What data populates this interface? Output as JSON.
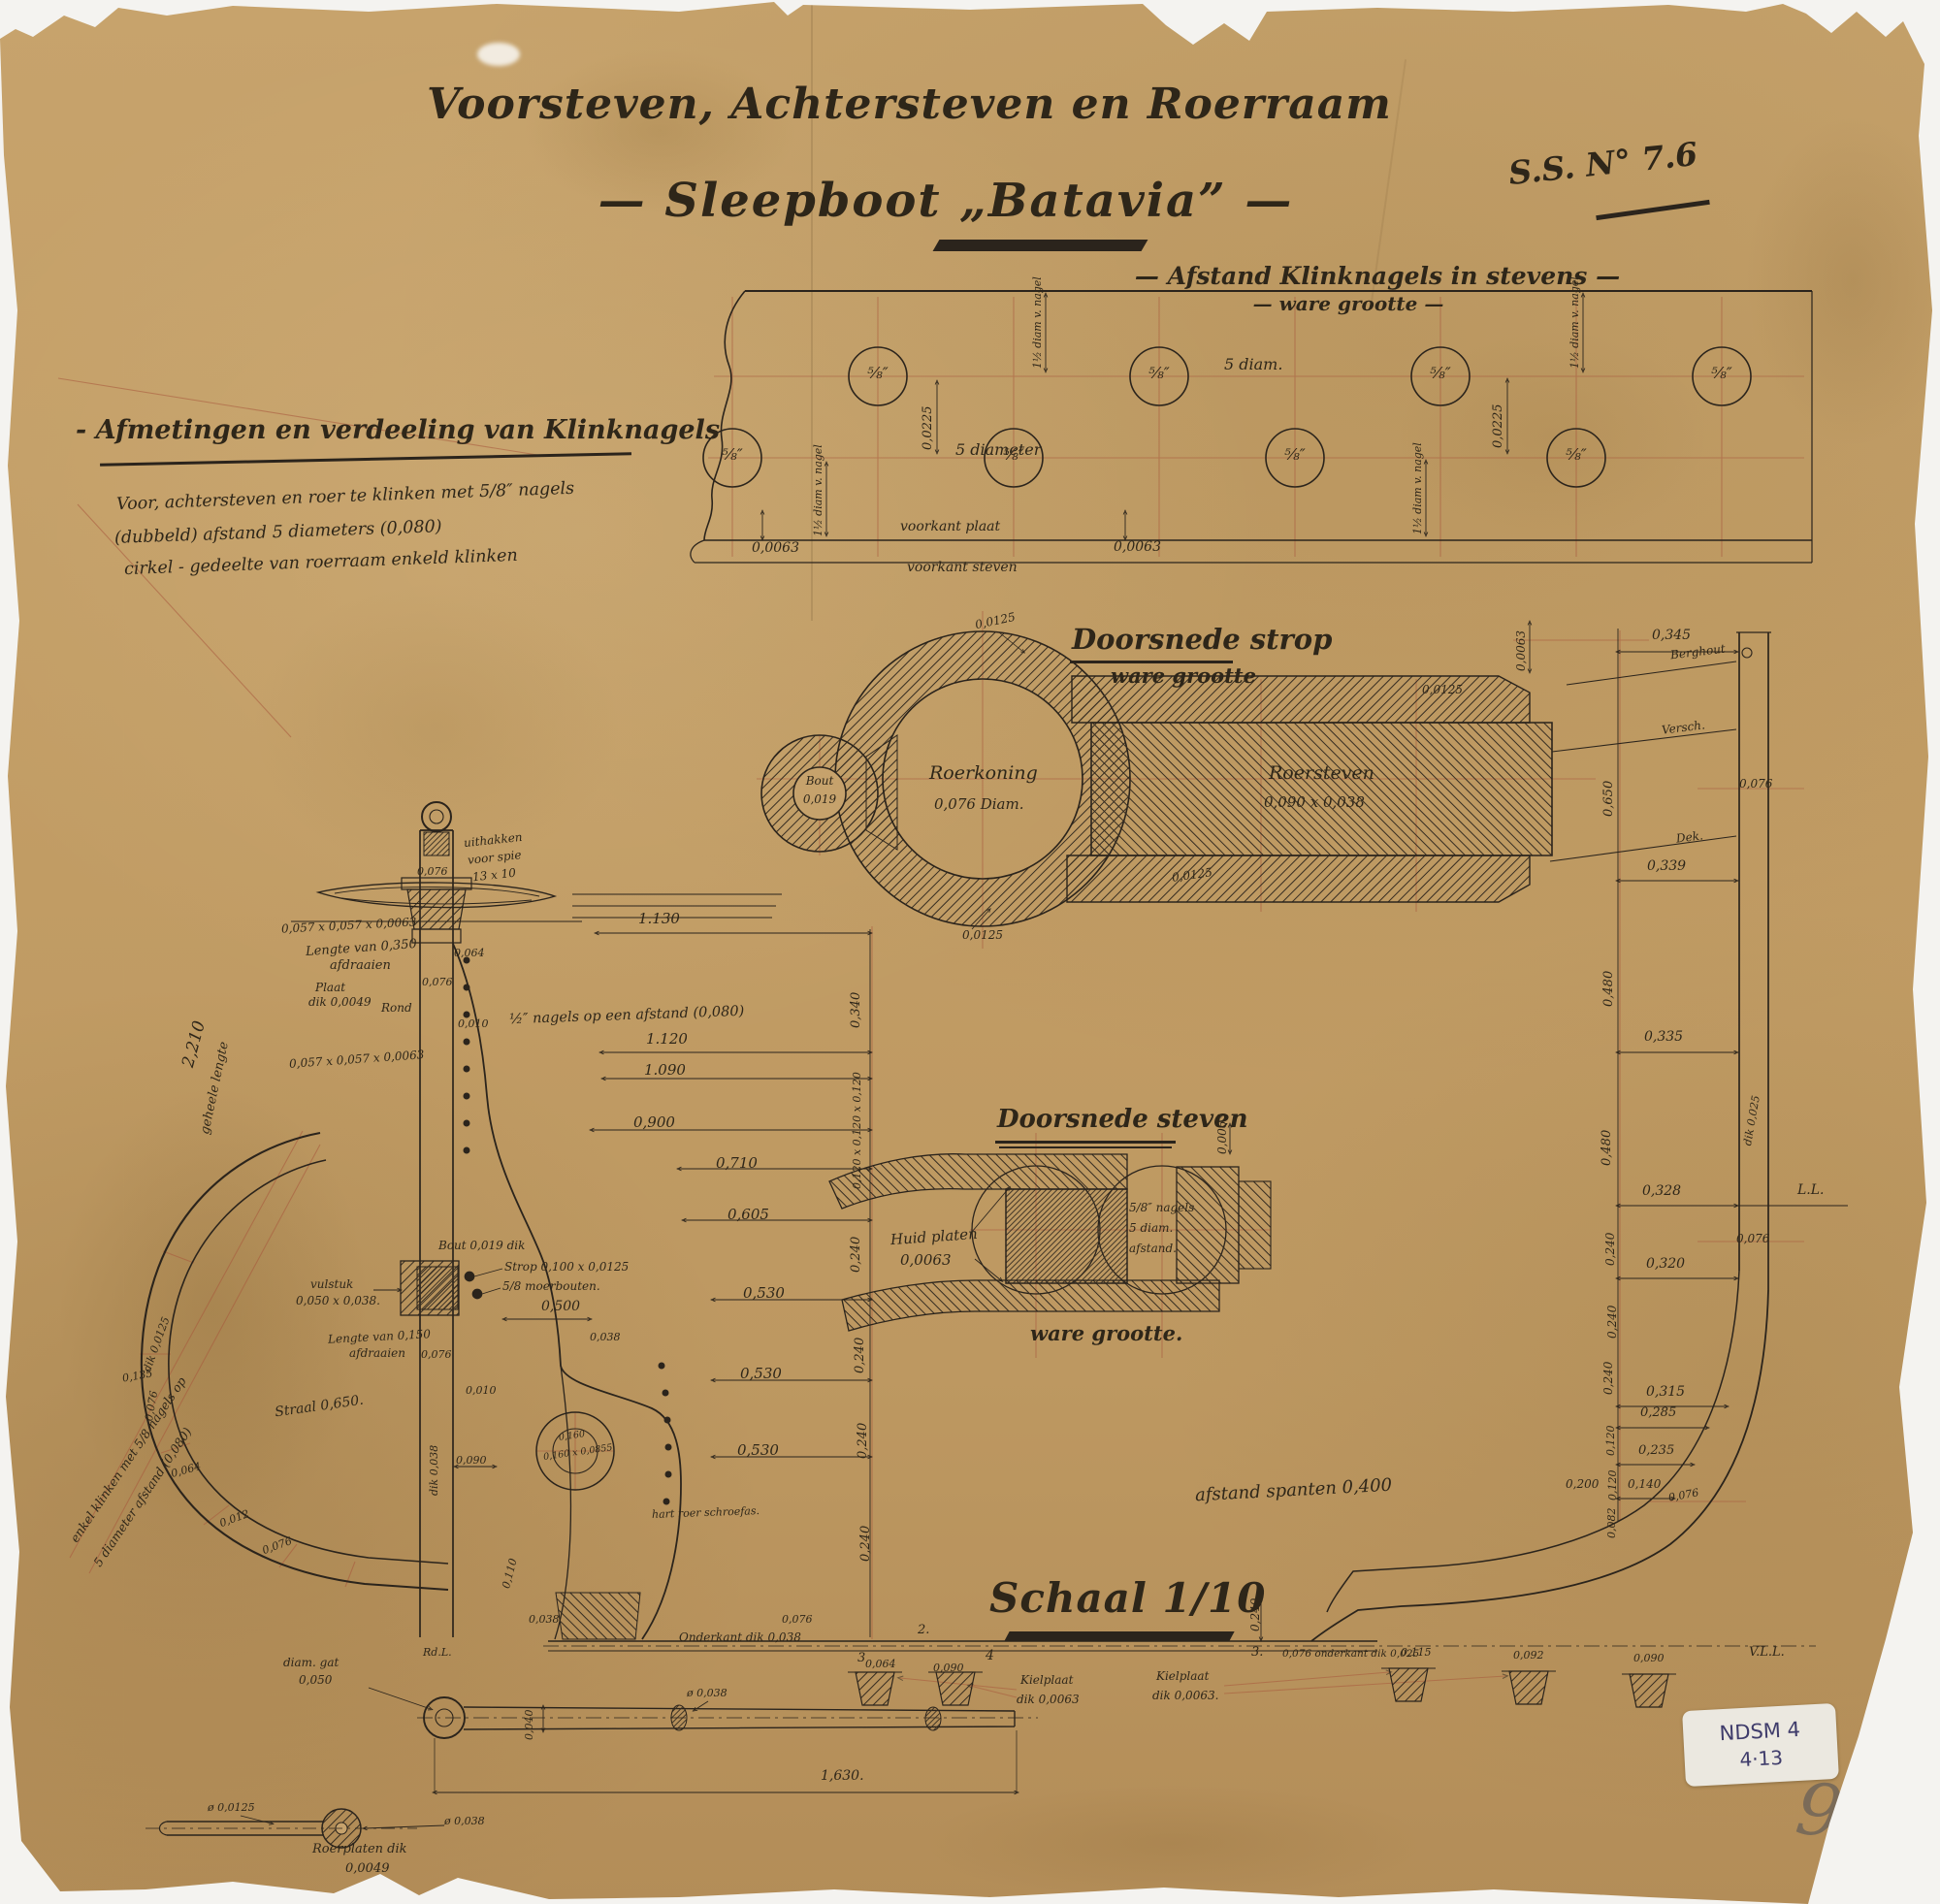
{
  "colors": {
    "paper": "#c29d65",
    "ink": "#2b241c",
    "red_construction": "#a8573c",
    "sticker_bg": "#ebe8e0",
    "sticker_ink": "#3f3c6b",
    "pencil": "#6d6358"
  },
  "header": {
    "title1": "Voorsteven, Achtersteven en Roerraam",
    "title2": "— Sleepboot „Batavia” —",
    "ssno": "S.S. N° 7.6"
  },
  "notes": {
    "heading": "- Afmetingen en verdeeling van Klinknagels",
    "l1": "Voor, achtersteven en roer te klinken met 5/8″ nagels",
    "l2": "(dubbeld)  afstand  5  diameters  (0,080)",
    "l3": "cirkel - gedeelte van roerraam  enkeld  klinken"
  },
  "plate": {
    "heading": "— Afstand Klinknagels in stevens —",
    "sub": "— ware grootte —",
    "rivet": "⅝″",
    "five_diam": "5 diam.",
    "five_diameter": "5  diameter",
    "diam_nagel": "1½ diam v. nagel",
    "d225": "0,0225",
    "d63": "0,0063",
    "voorkant_plaat": "voorkant plaat",
    "voorkant_steven": "voorkant steven"
  },
  "strop": {
    "title": "Doorsnede strop",
    "sub": "ware grootte",
    "bout1": "Bout",
    "bout2": "0,019",
    "rk1": "Roerkoning",
    "rk2": "0,076 Diam.",
    "rs1": "Roersteven",
    "rs2": "0,090 x 0,038",
    "t125": "0,0125",
    "d63": "0,0063"
  },
  "steven": {
    "title": "Doorsnede steven",
    "sub": "ware grootte.",
    "huid1": "Huid platen",
    "huid2": "0,0063",
    "n1": "5/8″ nagels",
    "n2": "5 diam.",
    "n3": "afstand.",
    "d63": "0,0063"
  },
  "lv": {
    "spie1": "uithakken",
    "spie2": "voor spie",
    "spie3": "13 x 10",
    "d076a": "0,076",
    "angle1": "0,057 x 0,057 x 0,0063",
    "l350a": "Lengte van 0,350",
    "l350b": "afdraaien",
    "plaat1": "Plaat",
    "plaat2": "dik 0,0049",
    "rond": "Rond",
    "d064": "0,064",
    "d076b": "0,076",
    "d010a": "0,010",
    "nagels": "½″ nagels op een afstand (0,080)",
    "angle2": "0,057 x 0,057 x 0,0063",
    "geheele": "geheele lengte",
    "g2210": "2,210",
    "klink1": "enkel klinken met 5/8 nagels op",
    "klink2": "5 diameter afstand (0,080)",
    "boutdik": "Bout 0,019 dik",
    "stropdim": "Strop 0,100 x 0,0125",
    "moer": "5/8 moerbouten.",
    "vul1": "vulstuk",
    "vul2": "0,050 x 0,038.",
    "l150a": "Lengte van 0,150",
    "l150b": "afdraaien",
    "d076c": "0,076",
    "d500": "0,500",
    "d038a": "0,038",
    "d010b": "0,010",
    "straal": "Straal 0,650.",
    "dik038": "dik 0,038",
    "d090": "0,090",
    "boss1": "0,160",
    "boss2": "0,160 x 0,0855",
    "dik125": "dik 0,0125",
    "r135": "0,135",
    "r076a": "0,076",
    "r064": "0,064",
    "r012": "0,012",
    "r076b": "0,076",
    "d110": "0,110",
    "d038b": "0,038",
    "rdl": "Rd.L.",
    "hart": "hart roer  schroefas."
  },
  "dims": {
    "a": "1.130",
    "b": "1.120",
    "c": "1.090",
    "d": "0,900",
    "e": "0,710",
    "f": "0,605",
    "g": "0,530",
    "r340": "0,340",
    "r120": "0,120 x 0,120 x 0,120",
    "r240": "0,240"
  },
  "profile": {
    "d345": "0,345",
    "berghout": "Berghout",
    "versch": "Versch.",
    "d650": "0,650",
    "d076a": "0,076",
    "dek": "Dek.",
    "d339": "0,339",
    "d480": "0,480",
    "d335": "0,335",
    "d328": "0,328",
    "ll": "L.L.",
    "dik025": "dik 0,025",
    "d076b": "0,076",
    "d240": "0,240",
    "d320": "0,320",
    "d315": "0,315",
    "d285": "0,285",
    "d120": "0,120",
    "d235": "0,235",
    "d200": "0,200",
    "d140": "0,140",
    "d082": "0,082",
    "d076c": "0,076",
    "vll": "V.L.L.",
    "n3b": "3.",
    "spanten": "afstand spanten 0,400"
  },
  "keel": {
    "schaal": "Schaal 1/10",
    "n2": "2.",
    "n3": "3",
    "n4": "4",
    "d064": "0,064",
    "d090": "0,090",
    "kiel1a": "Kielplaat",
    "kiel1b": "dik 0,0063",
    "kiel2a": "Kielplaat",
    "kiel2b": "dik 0,0063.",
    "d115": "0,115",
    "d092": "0,092",
    "d090b": "0,090",
    "onderkant_r": "0,076  onderkant dik 0,025",
    "d076l": "0,076",
    "onderkant_l": "Onderkant dik 0,038"
  },
  "bar": {
    "gat1": "diam. gat",
    "gat2": "0,050",
    "d038": "ø 0,038",
    "d040": "0,040",
    "len": "1,630."
  },
  "rod": {
    "d125": "ø 0,0125",
    "d038": "ø 0,038",
    "roer1": "Roerplaten dik",
    "roer2": "0,0049"
  },
  "sticker": {
    "l1": "NDSM 4",
    "l2": "4·13"
  },
  "page": {
    "num": "9"
  }
}
